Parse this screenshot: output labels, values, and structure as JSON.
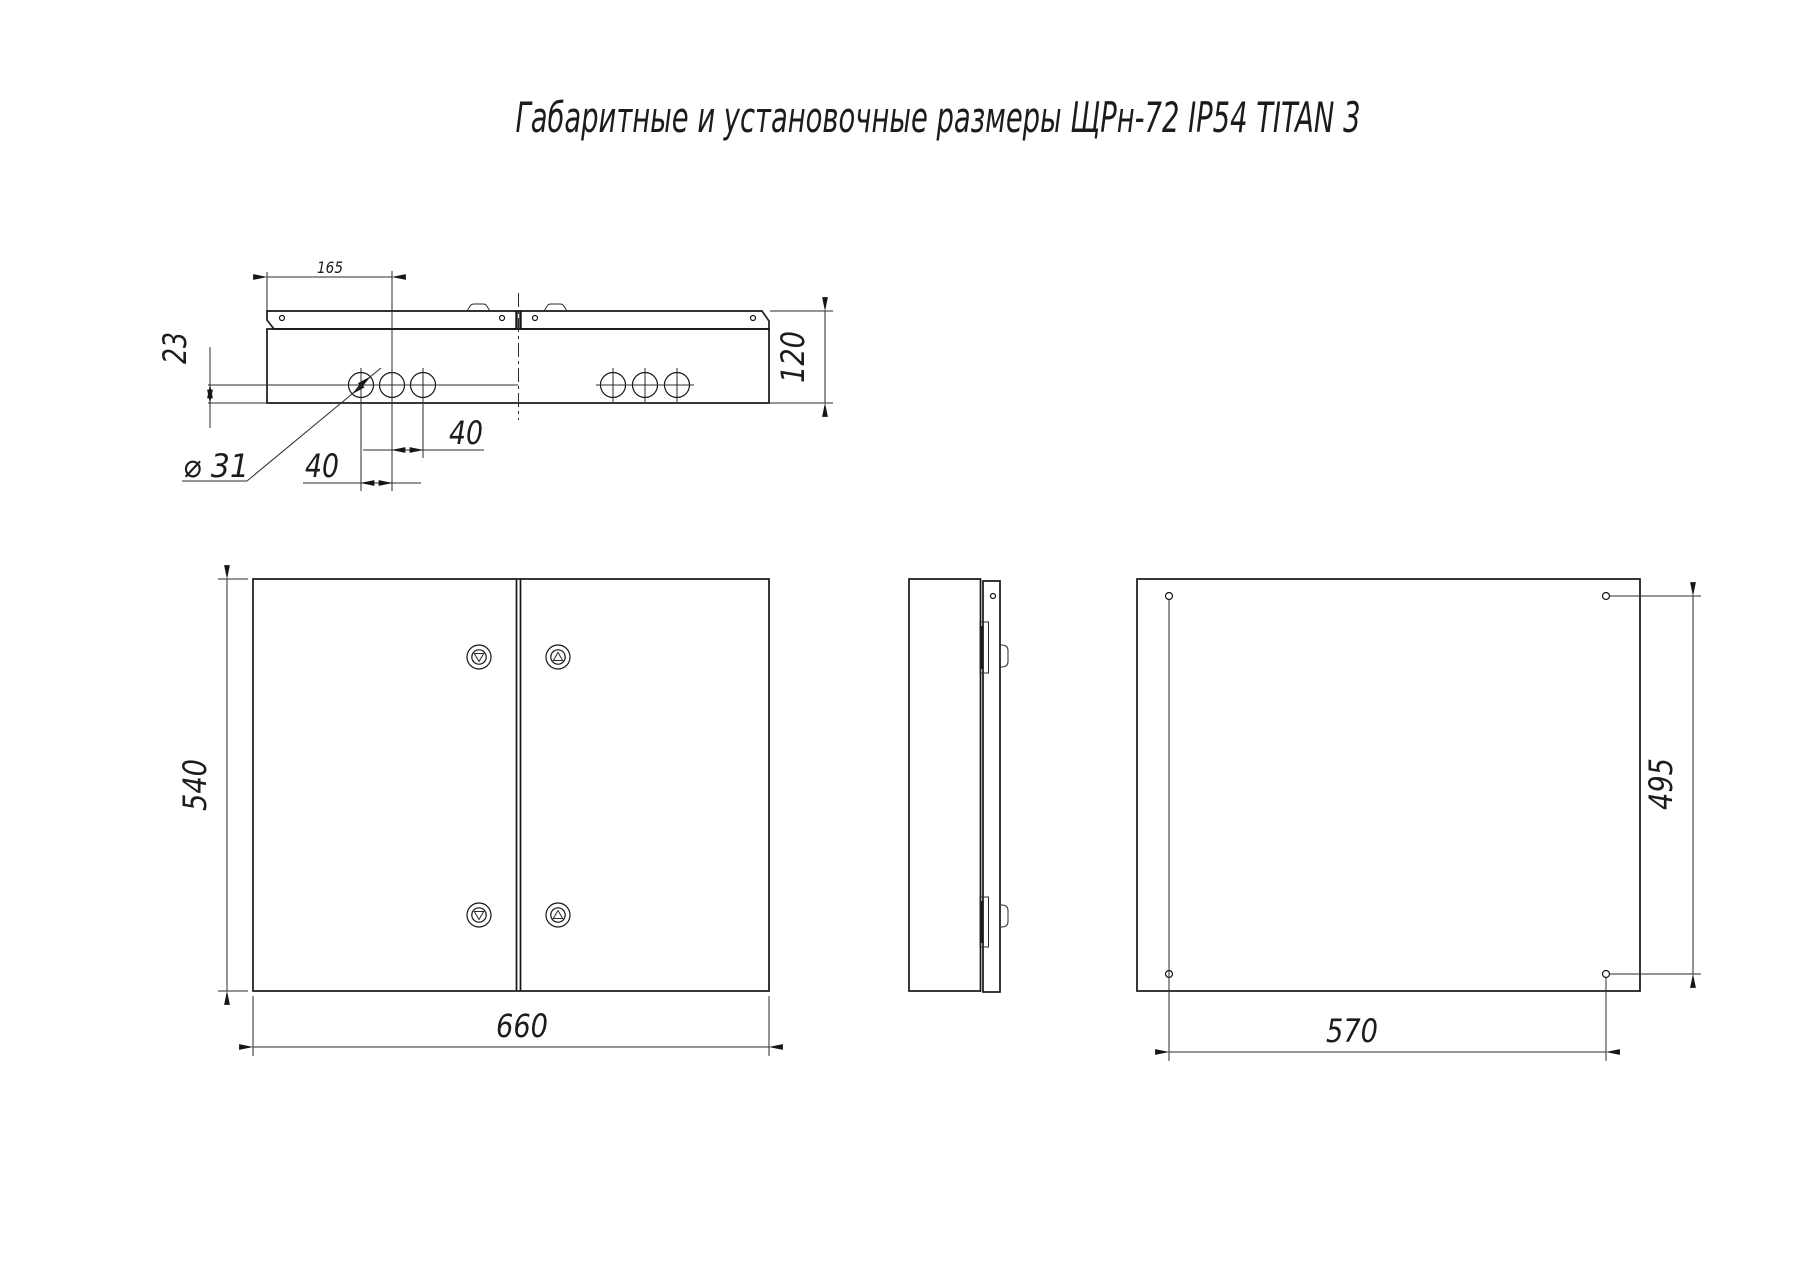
{
  "title": "Габаритные и установочные размеры ЩРн-72 IP54 TITAN 3",
  "drawing_colors": {
    "line": "#1c1c1c",
    "background": "#ffffff"
  },
  "views": {
    "top": {
      "dim_flange_to_hole": "165",
      "dim_hole_to_edge": "23",
      "dim_hole_diameter": "⌀ 31",
      "dim_hole_pitch_left": "40",
      "dim_hole_pitch_right": "40",
      "dim_depth": "120"
    },
    "front": {
      "dim_height": "540",
      "dim_width": "660"
    },
    "rear": {
      "dim_mount_height": "495",
      "dim_mount_width": "570"
    }
  }
}
